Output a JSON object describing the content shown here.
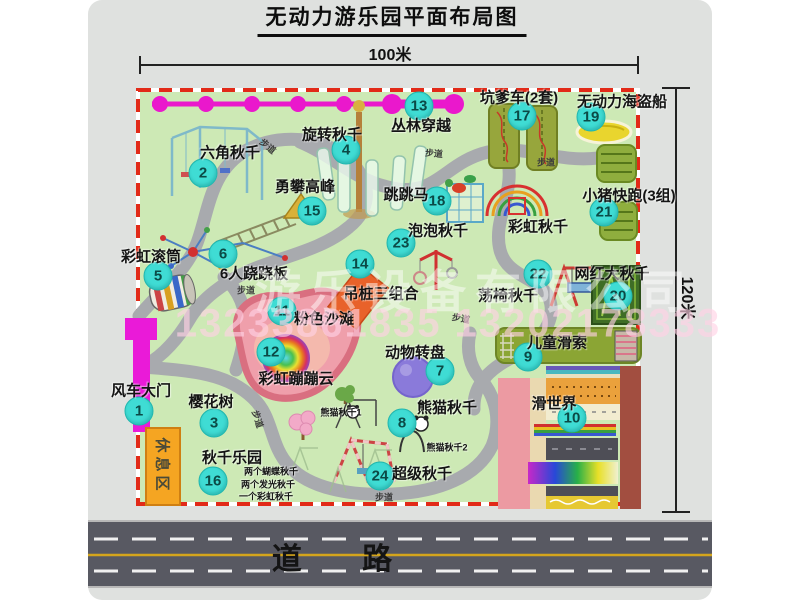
{
  "title": "无动力游乐园平面布局图",
  "dimensions": {
    "width": "100米",
    "height": "120米"
  },
  "road": {
    "label": "道 路"
  },
  "watermark": {
    "company": "游乐设备有限公司",
    "phone": "13233861835 13202178333"
  },
  "rest_area": "休息区",
  "path_label": "步道",
  "colors": {
    "park_fill": "#cde9b5",
    "park_border": "#e22a18",
    "badge": "#3fdcd4",
    "walkway": "#a8aaae",
    "road": "#585962",
    "gate": "#ea1ad8",
    "rest_area": "#f5a522",
    "zipline": "#ea18cc"
  },
  "attractions": [
    {
      "num": "1",
      "label": "风车大门",
      "lx": 141,
      "ly": 390,
      "bx": 139,
      "by": 411
    },
    {
      "num": "2",
      "label": "六角秋千",
      "lx": 230,
      "ly": 152,
      "bx": 203,
      "by": 173
    },
    {
      "num": "3",
      "label": "樱花树",
      "lx": 211,
      "ly": 401,
      "bx": 214,
      "by": 423
    },
    {
      "num": "4",
      "label": "旋转秋千",
      "lx": 332,
      "ly": 134,
      "bx": 346,
      "by": 150
    },
    {
      "num": "5",
      "label": "彩虹滚筒",
      "lx": 151,
      "ly": 256,
      "bx": 158,
      "by": 276
    },
    {
      "num": "6",
      "label": "6人跷跷板",
      "lx": 254,
      "ly": 273,
      "bx": 223,
      "by": 254
    },
    {
      "num": "7",
      "label": "动物转盘",
      "lx": 415,
      "ly": 352,
      "bx": 440,
      "by": 371
    },
    {
      "num": "8",
      "label": "熊猫秋千",
      "lx": 447,
      "ly": 407,
      "bx": 402,
      "by": 423
    },
    {
      "num": "9",
      "label": "儿童滑索",
      "lx": 557,
      "ly": 342,
      "bx": 528,
      "by": 357
    },
    {
      "num": "10",
      "label": "滑世界",
      "lx": 554,
      "ly": 403,
      "bx": 572,
      "by": 418
    },
    {
      "num": "11",
      "label": "粉色沙滩",
      "lx": 324,
      "ly": 318,
      "bx": 282,
      "by": 311
    },
    {
      "num": "12",
      "label": "彩虹蹦蹦云",
      "lx": 296,
      "ly": 378,
      "bx": 271,
      "by": 352
    },
    {
      "num": "13",
      "label": "丛林穿越",
      "lx": 421,
      "ly": 125,
      "bx": 419,
      "by": 106
    },
    {
      "num": "14",
      "label": "吊桩三组合",
      "lx": 381,
      "ly": 293,
      "bx": 360,
      "by": 264
    },
    {
      "num": "15",
      "label": "勇攀高峰",
      "lx": 305,
      "ly": 186,
      "bx": 312,
      "by": 211
    },
    {
      "num": "16",
      "label": "秋千乐园",
      "lx": 232,
      "ly": 457,
      "bx": 213,
      "by": 481
    },
    {
      "num": "17",
      "label": "坑爹车(2套)",
      "lx": 519,
      "ly": 97,
      "bx": 522,
      "by": 116
    },
    {
      "num": "18",
      "label": "跳跳马",
      "lx": 406,
      "ly": 194,
      "bx": 437,
      "by": 201
    },
    {
      "num": "19",
      "label": "无动力海盗船",
      "lx": 622,
      "ly": 101,
      "bx": 591,
      "by": 117
    },
    {
      "num": "20",
      "label": "网红大秋千",
      "lx": 612,
      "ly": 273,
      "bx": 618,
      "by": 296
    },
    {
      "num": "21",
      "label": "小猪快跑(3组)",
      "lx": 629,
      "ly": 195,
      "bx": 604,
      "by": 212
    },
    {
      "num": "22",
      "label": "荡椅秋千",
      "lx": 508,
      "ly": 295,
      "bx": 538,
      "by": 274
    },
    {
      "num": "23",
      "label": "泡泡秋千",
      "lx": 438,
      "ly": 230,
      "bx": 401,
      "by": 243
    },
    {
      "num": "24",
      "label": "超级秋千",
      "lx": 422,
      "ly": 473,
      "bx": 380,
      "by": 476
    }
  ],
  "extra_labels": [
    {
      "text": "彩虹秋千",
      "x": 538,
      "y": 226,
      "size": 15
    },
    {
      "text": "熊猫秋千1",
      "x": 341,
      "y": 412,
      "size": 9
    },
    {
      "text": "熊猫秋千2",
      "x": 447,
      "y": 447,
      "size": 9
    },
    {
      "text": "两个蝴蝶秋千",
      "x": 271,
      "y": 471,
      "size": 9
    },
    {
      "text": "两个发光秋千",
      "x": 268,
      "y": 484,
      "size": 9
    },
    {
      "text": "一个彩虹秋千",
      "x": 266,
      "y": 496,
      "size": 9
    }
  ],
  "path_labels": [
    {
      "x": 268,
      "y": 146,
      "rot": 40
    },
    {
      "x": 434,
      "y": 153,
      "rot": 5
    },
    {
      "x": 546,
      "y": 162,
      "rot": 0
    },
    {
      "x": 246,
      "y": 290,
      "rot": 0
    },
    {
      "x": 461,
      "y": 318,
      "rot": 10
    },
    {
      "x": 384,
      "y": 497,
      "rot": 0
    },
    {
      "x": 258,
      "y": 419,
      "rot": 72
    }
  ]
}
